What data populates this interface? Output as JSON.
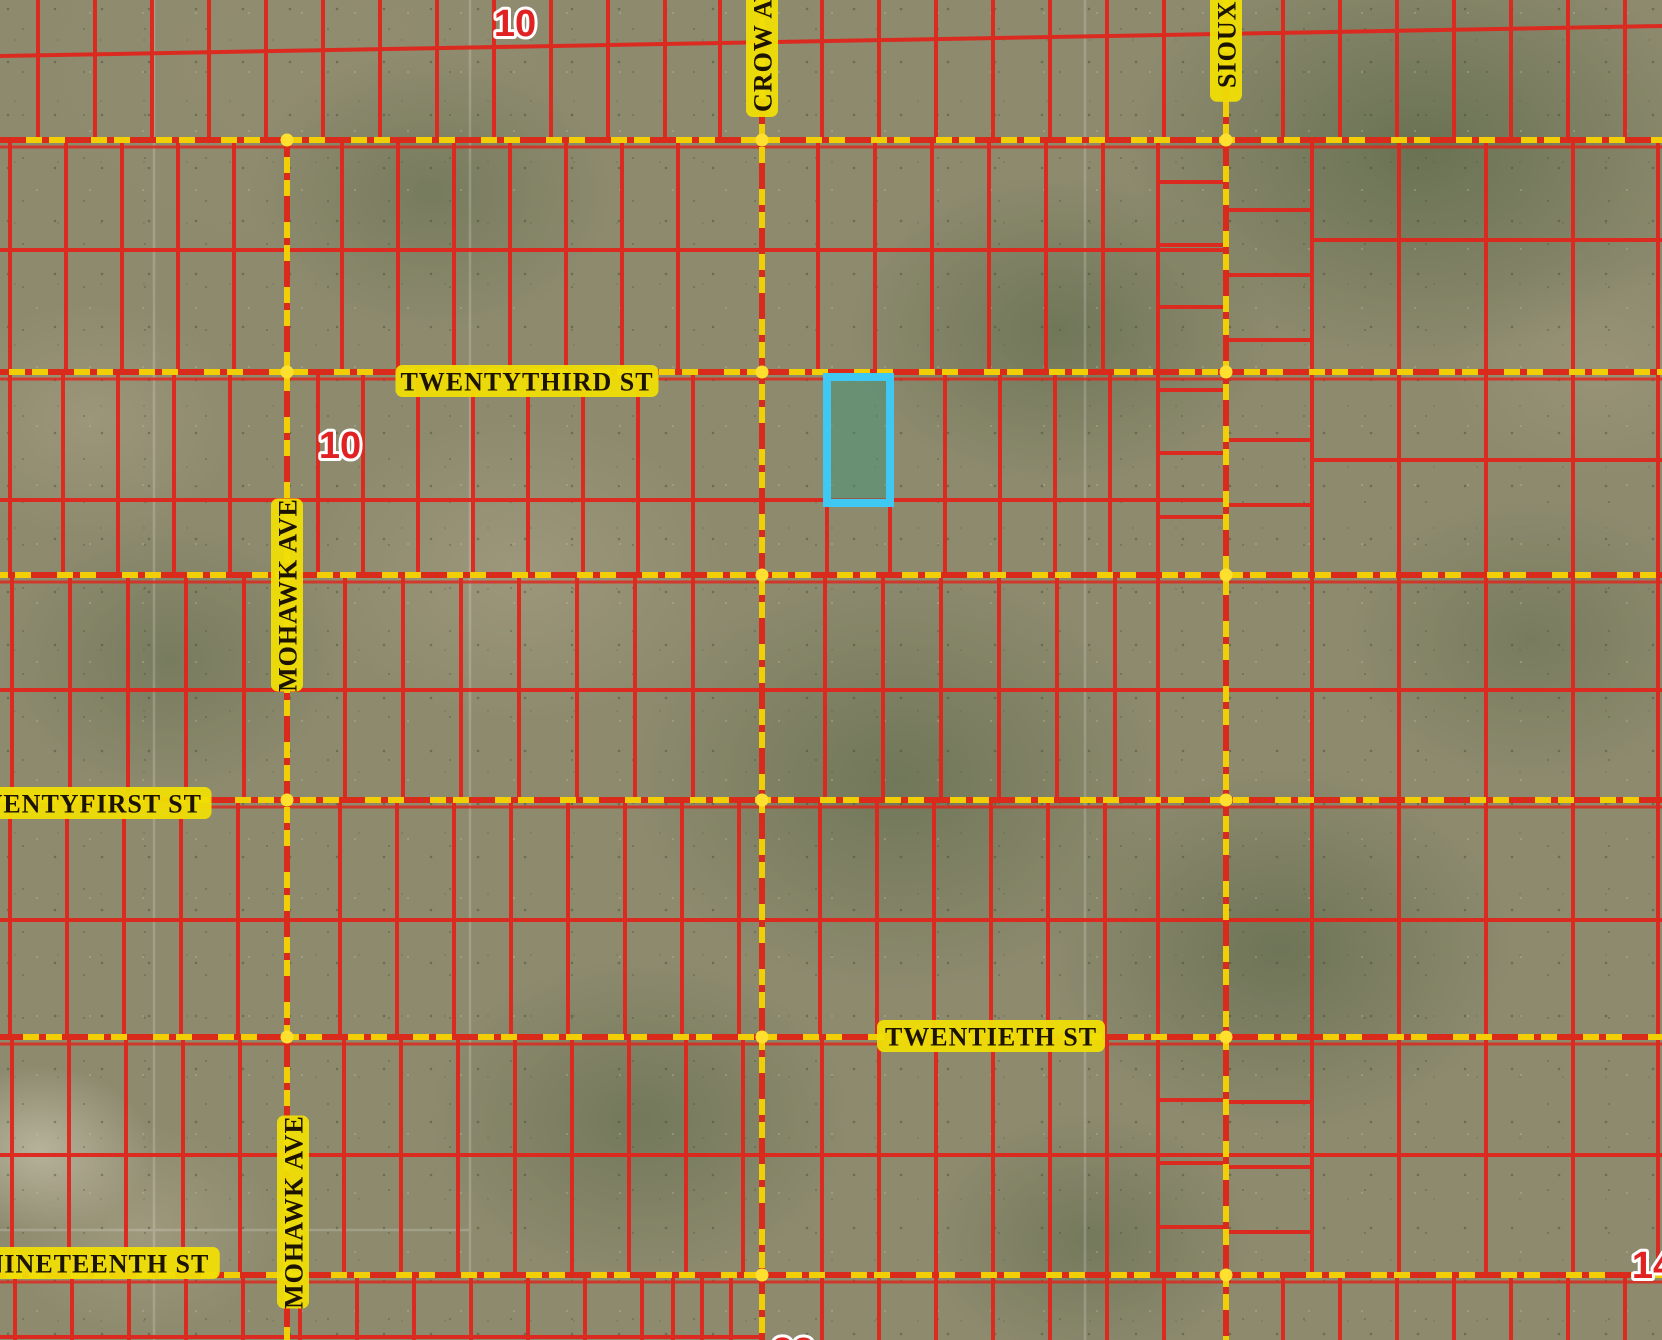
{
  "map": {
    "type": "parcel-map-satellite-view",
    "width": 1662,
    "height": 1340
  },
  "colors": {
    "terrain_base": "#8d8a6e",
    "parcel_line": "#e0261c",
    "road_yellow": "#f2ce06",
    "road_red_dash": "#d92a1c",
    "intersection_dot": "#ffe02e",
    "label_text": "#1c1400",
    "label_halo": "#f0de05",
    "marker_red": "#e02222",
    "marker_halo": "#ffffff",
    "selected_stroke": "#3fc8f2",
    "selected_fill": "rgba(62,150,122,0.45)",
    "faint_line": "#ffffff"
  },
  "streets": {
    "horizontal": [
      {
        "name": "",
        "y": 140
      },
      {
        "name": "TWENTYTHIRD ST",
        "y": 372,
        "label": {
          "x": 527,
          "y": 381,
          "rotate": 0
        }
      },
      {
        "name": "",
        "y": 575
      },
      {
        "name": "TWENTYFIRST ST",
        "y": 800,
        "label": {
          "x": 80,
          "y": 803,
          "rotate": 0
        }
      },
      {
        "name": "TWENTIETH ST",
        "y": 1037,
        "label": {
          "x": 991,
          "y": 1036,
          "rotate": 0
        }
      },
      {
        "name": "NINETEENTH ST",
        "y": 1275,
        "label": {
          "x": 97,
          "y": 1263,
          "rotate": 0
        }
      }
    ],
    "vertical": [
      {
        "name": "MOHAWK AVE",
        "x": 287,
        "y1": 140,
        "y2": 1340,
        "labels": [
          {
            "x": 287,
            "y": 595,
            "rotate": -90
          },
          {
            "x": 293,
            "y": 1212,
            "rotate": -90
          }
        ]
      },
      {
        "name": "CROW AVE",
        "x": 762,
        "y1": 0,
        "y2": 1340,
        "labels": [
          {
            "x": 762,
            "y": 38,
            "rotate": -90
          }
        ]
      },
      {
        "name": "SIOUX AVE",
        "x": 1226,
        "y1": 0,
        "y2": 1340,
        "labels": [
          {
            "x": 1226,
            "y": 14,
            "rotate": -90
          }
        ]
      }
    ]
  },
  "section_markers": [
    {
      "value": "10",
      "x": 515,
      "y": 24
    },
    {
      "value": "10",
      "x": 340,
      "y": 446
    },
    {
      "value": "14",
      "x": 1653,
      "y": 1266
    },
    {
      "value": "23",
      "x": 793,
      "y": 1352
    }
  ],
  "selected_parcel": {
    "x": 827,
    "y": 377,
    "width": 63,
    "height": 126
  },
  "parcel_grid": {
    "bands": [
      {
        "y1": 0,
        "y2": 140,
        "xs": [
          38,
          95,
          152,
          209,
          266,
          323,
          380,
          437,
          494,
          551,
          608,
          665,
          720,
          822,
          879,
          936,
          993,
          1050,
          1107,
          1164,
          1283,
          1340,
          1397,
          1454,
          1511,
          1568,
          1625
        ],
        "h": [
          {
            "y1": 56,
            "y2": 26,
            "x1": 0,
            "x2": 1662
          }
        ]
      },
      {
        "y1": 140,
        "y2": 372,
        "xs": [
          10,
          66,
          122,
          178,
          234,
          342,
          398,
          454,
          510,
          566,
          622,
          678,
          818,
          875,
          932,
          989,
          1046,
          1103,
          1158,
          1312,
          1399,
          1486,
          1573,
          1658
        ],
        "h": [
          {
            "y1": 250,
            "y2": 250,
            "x1": 0,
            "x2": 1226
          },
          {
            "y1": 240,
            "y2": 240,
            "x1": 1312,
            "x2": 1662
          }
        ]
      },
      {
        "y1": 372,
        "y2": 575,
        "xs": [
          10,
          63,
          118,
          174,
          230,
          318,
          363,
          418,
          473,
          528,
          583,
          638,
          693,
          827,
          890,
          945,
          1000,
          1055,
          1110,
          1158,
          1312,
          1399,
          1486,
          1573,
          1658
        ],
        "h": [
          {
            "y1": 500,
            "y2": 500,
            "x1": 0,
            "x2": 1226
          },
          {
            "y1": 460,
            "y2": 460,
            "x1": 1312,
            "x2": 1662
          }
        ]
      },
      {
        "y1": 575,
        "y2": 800,
        "xs": [
          12,
          70,
          128,
          186,
          244,
          345,
          403,
          461,
          519,
          577,
          635,
          693,
          825,
          883,
          941,
          999,
          1057,
          1115,
          1158,
          1312,
          1399,
          1486,
          1573,
          1658
        ],
        "h": [
          {
            "y1": 690,
            "y2": 690,
            "x1": 0,
            "x2": 1662
          }
        ]
      },
      {
        "y1": 800,
        "y2": 1037,
        "xs": [
          10,
          67,
          124,
          181,
          238,
          340,
          397,
          454,
          511,
          568,
          625,
          682,
          739,
          820,
          877,
          934,
          991,
          1048,
          1105,
          1158,
          1312,
          1399,
          1486,
          1573,
          1658
        ],
        "h": [
          {
            "y1": 920,
            "y2": 920,
            "x1": 0,
            "x2": 1662
          }
        ]
      },
      {
        "y1": 1037,
        "y2": 1275,
        "xs": [
          12,
          69,
          126,
          183,
          240,
          344,
          401,
          458,
          515,
          572,
          629,
          686,
          743,
          822,
          879,
          936,
          993,
          1050,
          1107,
          1158,
          1312,
          1399,
          1486,
          1573,
          1658
        ],
        "h": [
          {
            "y1": 1155,
            "y2": 1155,
            "x1": 0,
            "x2": 1662
          }
        ]
      },
      {
        "y1": 1275,
        "y2": 1340,
        "xs": [
          15,
          72,
          129,
          186,
          243,
          300,
          357,
          414,
          471,
          528,
          585,
          642,
          673,
          702,
          731,
          822,
          879,
          936,
          993,
          1050,
          1107,
          1164,
          1283,
          1340,
          1397,
          1454,
          1511,
          1568,
          1625
        ],
        "h": [
          {
            "y1": 1337,
            "y2": 1337,
            "x1": 0,
            "x2": 762
          }
        ]
      }
    ],
    "ladders": [
      {
        "x1": 1158,
        "x2": 1226,
        "ys": [
          182,
          245,
          307,
          390,
          453,
          517,
          1100,
          1163,
          1227
        ]
      },
      {
        "x1": 1226,
        "x2": 1312,
        "ys": [
          210,
          275,
          340,
          440,
          505,
          1102,
          1167,
          1232
        ]
      }
    ]
  },
  "faint_imagery_lines": {
    "verticals": [
      154,
      470,
      1085
    ],
    "horizontals": [
      {
        "y": 1230,
        "x1": 0,
        "x2": 470
      }
    ]
  }
}
